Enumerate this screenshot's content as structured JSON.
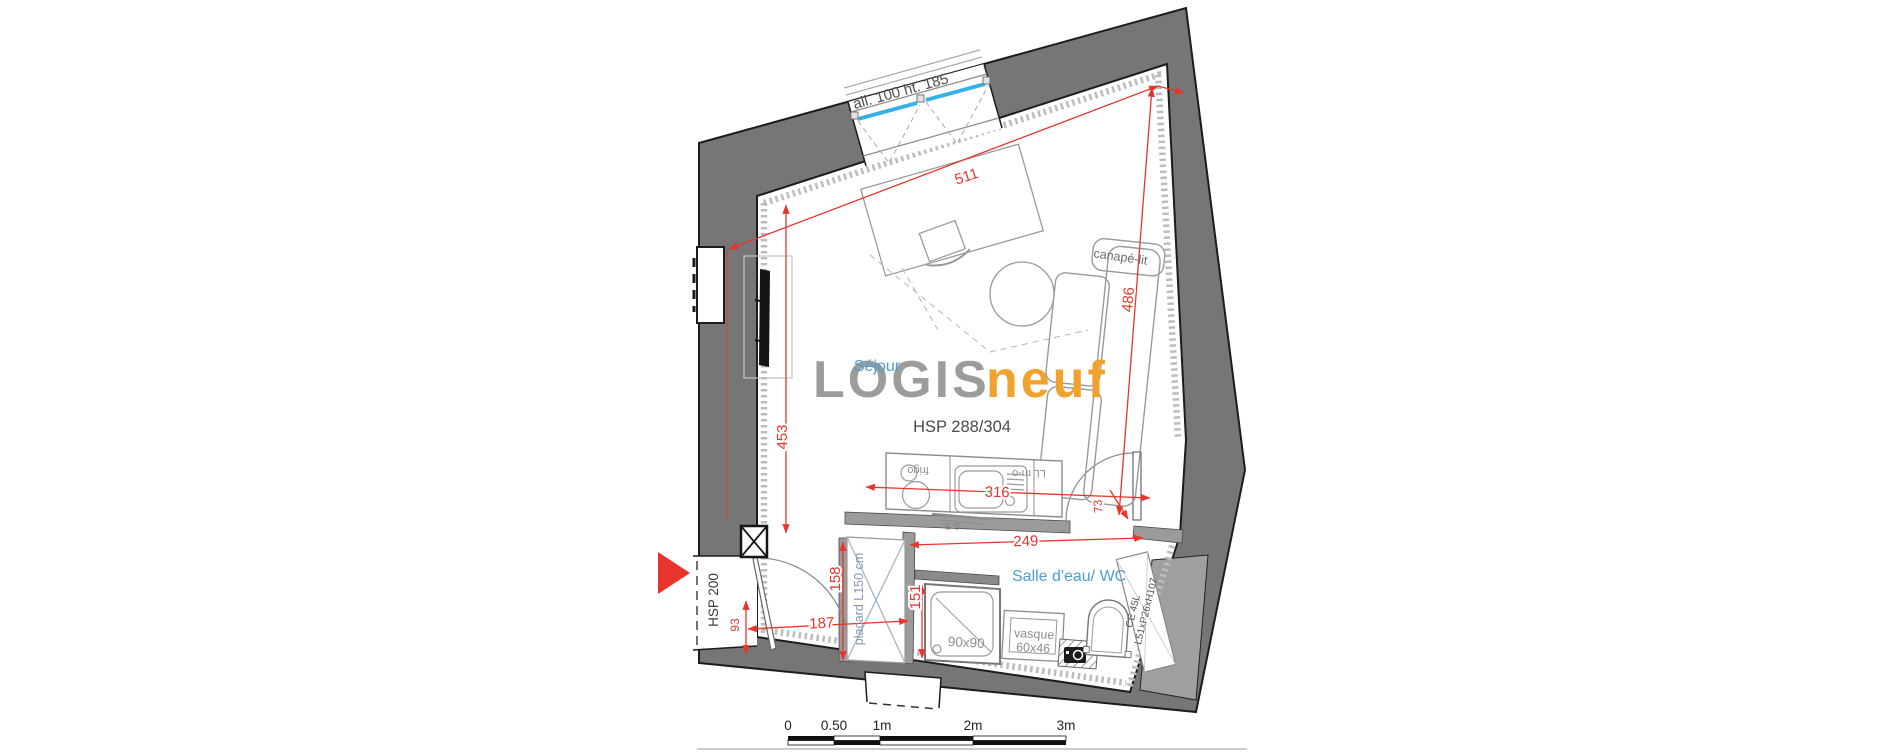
{
  "plan": {
    "watermark": {
      "logis": "LOGIS",
      "neuf": "neuf"
    },
    "rooms": {
      "sejour": "Séjour",
      "bathroom": "Salle d'eau/ WC"
    },
    "annotations": {
      "window_allege": "all. 100 ht. 185",
      "ceiling_height_main": "HSP 288/304",
      "ceiling_height_entry": "HSP 200",
      "sofa_bed": "canapé-lit",
      "closet": "placard L150 cm",
      "shower_size": "90x90",
      "basin_line1": "vasque",
      "basin_line2": "60x46",
      "fridge": "frigo",
      "washer_microwave": "LL m-o",
      "towel_dryer": "S.S.",
      "water_heater_line1": "CE 45L",
      "water_heater_line2": "L51xP26xH107"
    },
    "dimensions": {
      "width_top": "511",
      "height_right": "486",
      "height_left": "453",
      "kitchen_width": "316",
      "bathroom_width": "249",
      "closet_depth": "158",
      "shower_depth": "151",
      "entry_width": "187",
      "entry_recess": "93",
      "door_width": "73"
    },
    "scale_bar": {
      "tick_0": "0",
      "tick_05": "0.50",
      "tick_1": "1m",
      "tick_2": "2m",
      "tick_3": "3m"
    },
    "colors": {
      "wall": "#767676",
      "dimension_red": "#e8352c",
      "label_blue": "#4c9fd6",
      "glazing_blue": "#35b1e8",
      "logo_gray": "#9c9c9b",
      "logo_orange": "#f0a22e"
    }
  }
}
